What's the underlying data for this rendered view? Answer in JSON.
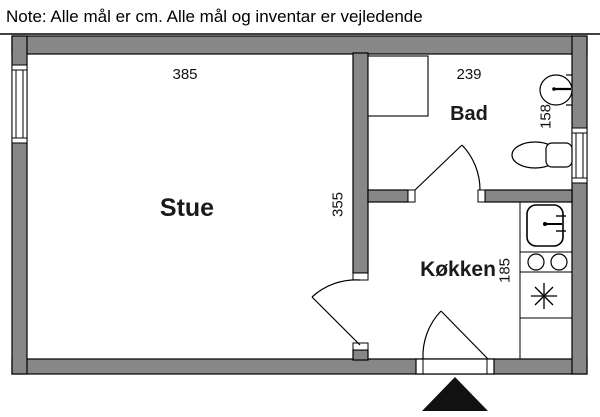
{
  "note": "Note: Alle mål er cm. Alle mål og inventar er vejledende",
  "rooms": {
    "stue": "Stue",
    "bad": "Bad",
    "kokken": "Køkken"
  },
  "dimensions_cm": {
    "stue_width": "385",
    "stue_depth": "355",
    "bad_width": "239",
    "bad_depth": "158",
    "kokken_depth": "185"
  },
  "colors": {
    "wall_fill": "#878787",
    "outline": "#000000",
    "background": "#ffffff",
    "entrance_marker": "#111111"
  },
  "fixtures": [
    "window-left",
    "window-right",
    "shower-area",
    "hand-basin",
    "toilet",
    "kitchen-sink",
    "two-burner-hob",
    "fridge",
    "door-bad",
    "door-stue-kokken",
    "door-entrance",
    "entrance-triangle"
  ]
}
